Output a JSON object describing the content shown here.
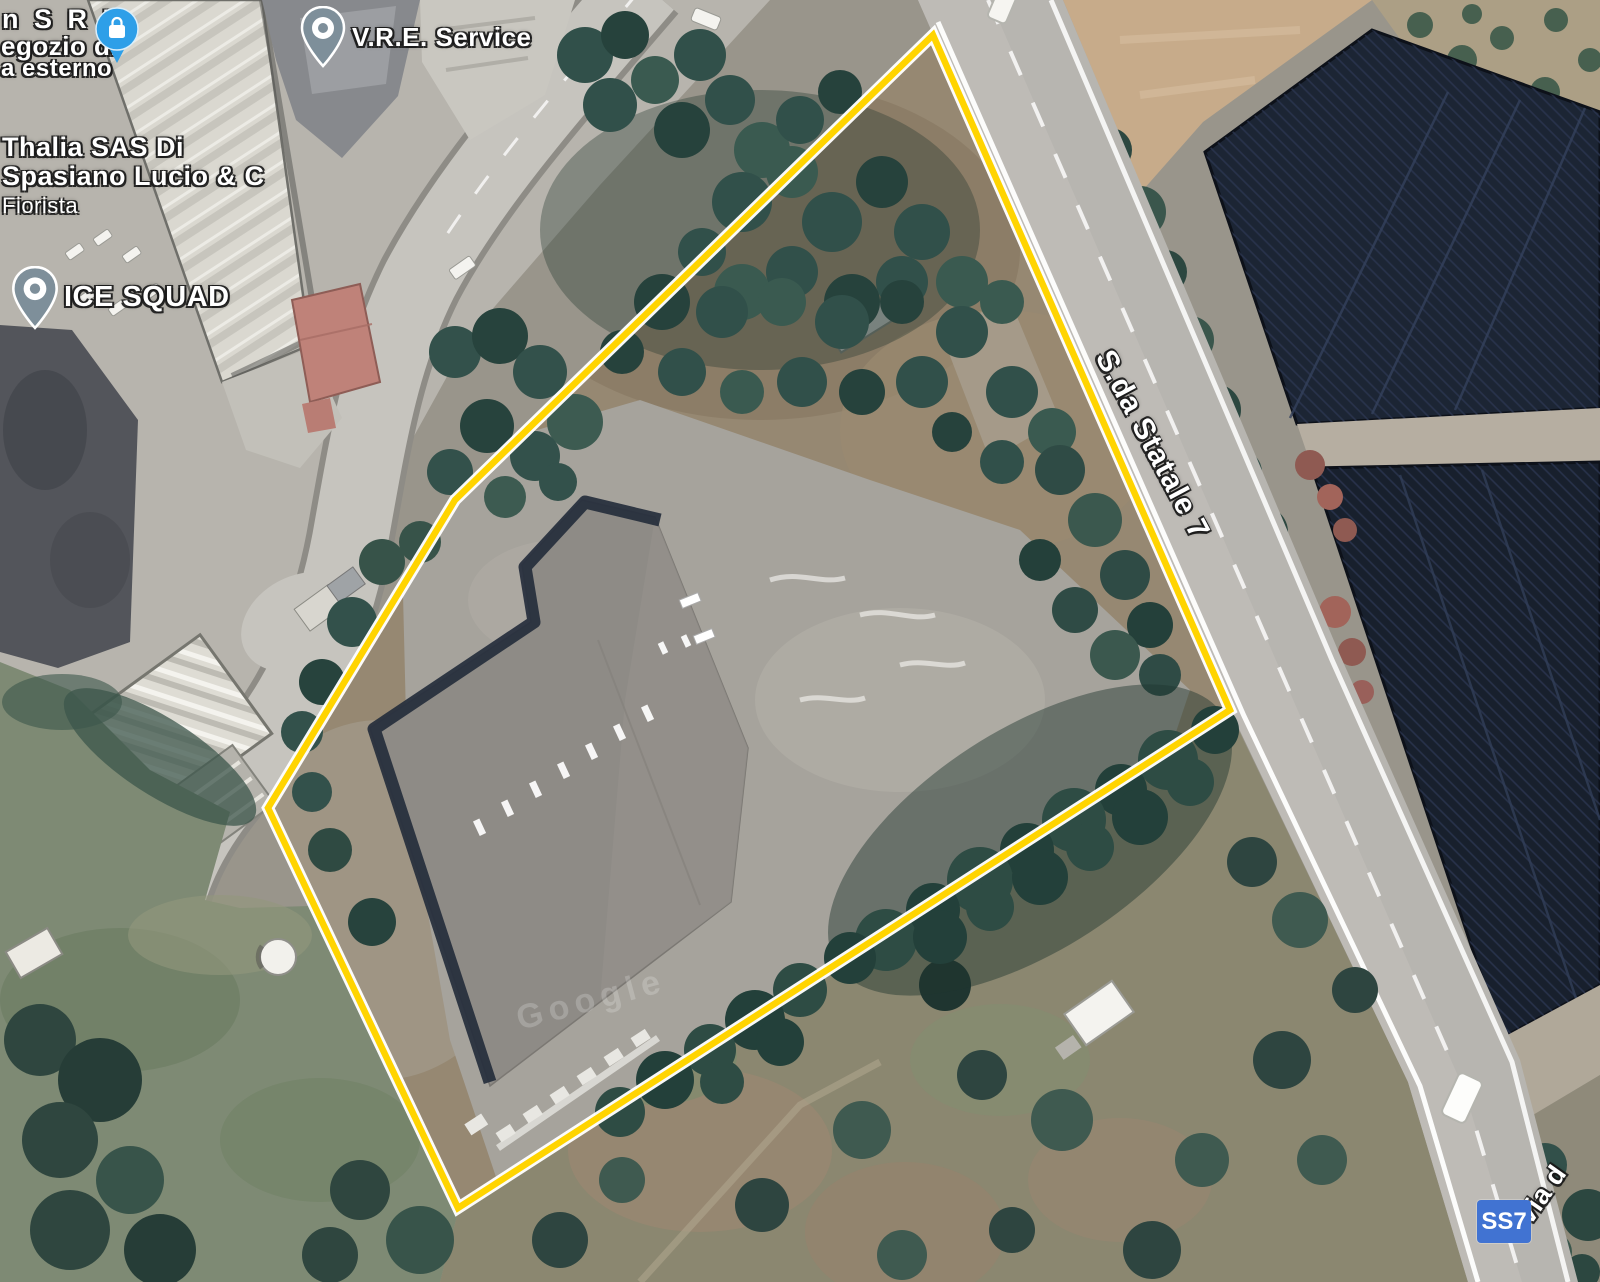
{
  "map": {
    "type": "satellite-imagery",
    "watermark": "Google",
    "boundary_color": "#ffd400",
    "boundary_casing_color": "#ffffff"
  },
  "pois": [
    {
      "id": "negozio-partial",
      "line1": "n S R L",
      "line2": "egozio di",
      "line3": "a esterno",
      "icon": "shopping-pin",
      "icon_color": "#2e9fe8"
    },
    {
      "id": "vre-service",
      "name": "V.R.E. Service",
      "icon": "place-pin",
      "icon_color": "#7e8f9a"
    },
    {
      "id": "thalia",
      "line1": "Thalia SAS Di",
      "line2": "Spasiano Lucio & C",
      "line3": "Fiorista"
    },
    {
      "id": "ice-squad",
      "name": "ICE SQUAD",
      "icon": "place-pin",
      "icon_color": "#7e8f9a"
    }
  ],
  "roads": {
    "main_label": "S.da Statale 7",
    "route_shield": "SS7",
    "shield_color": "#4173d2",
    "secondary_label": "via d"
  }
}
